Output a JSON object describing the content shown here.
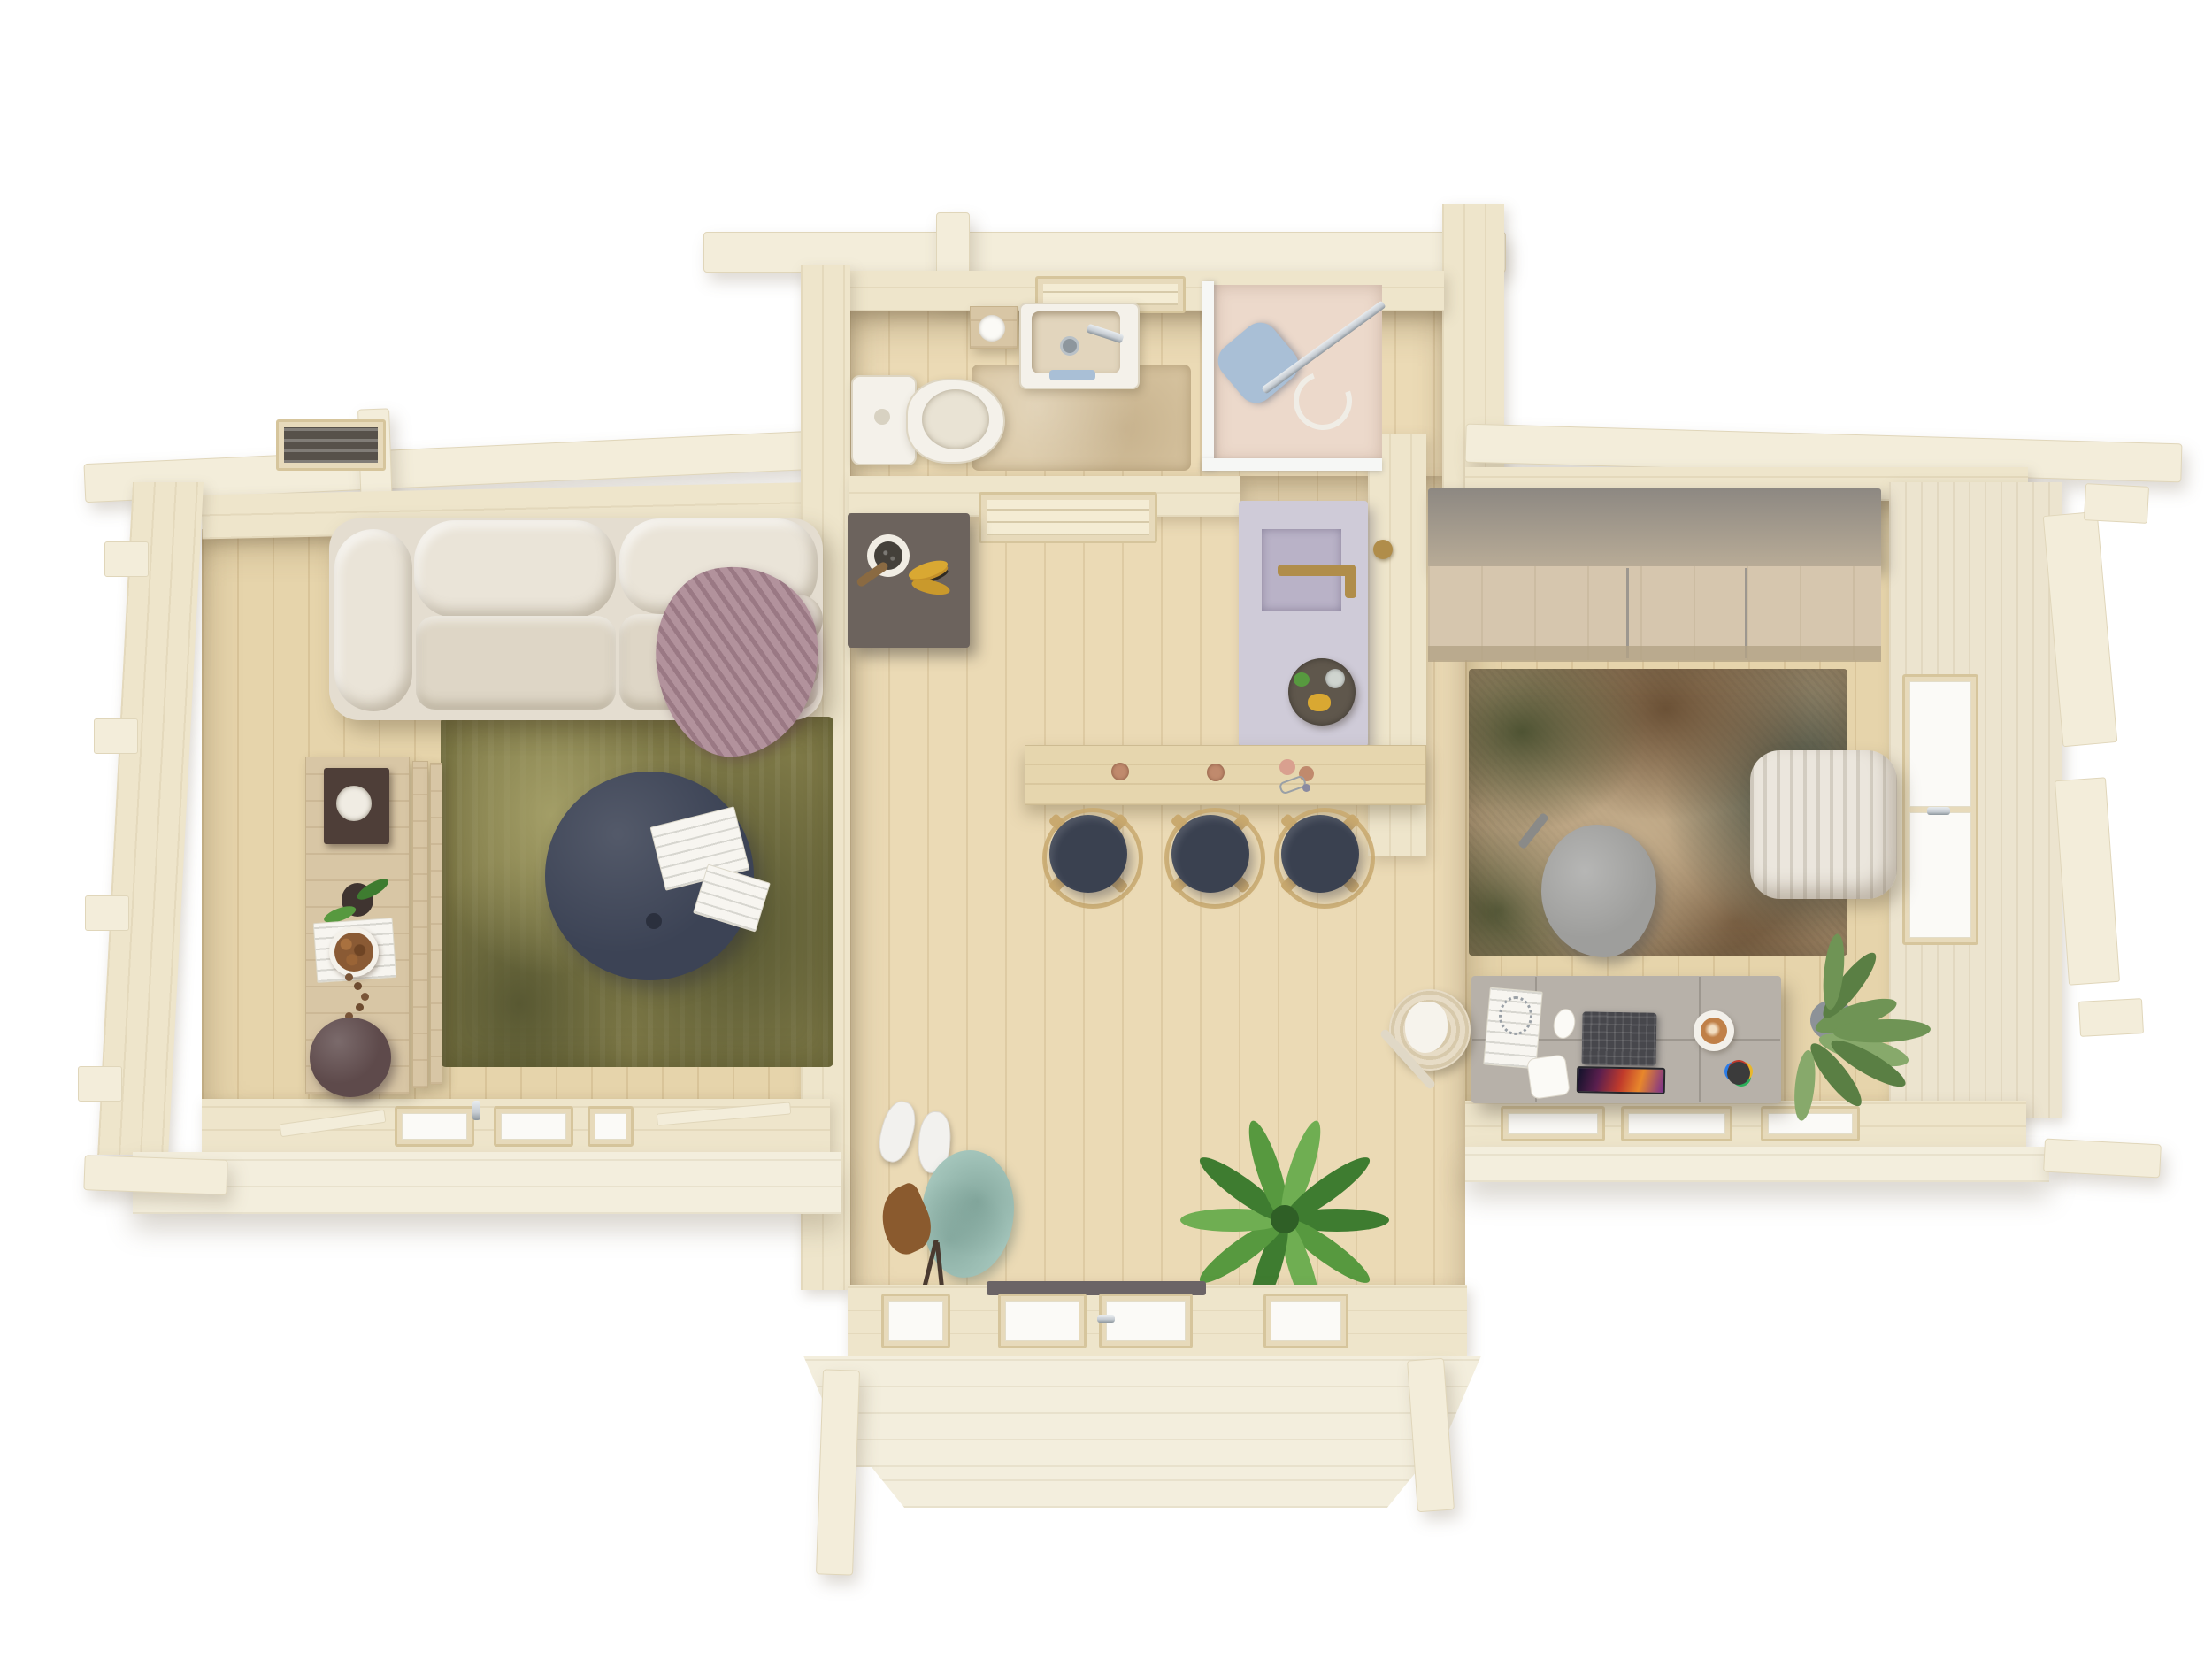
{
  "scene": {
    "title": "log-cabin-floor-plan-top-view",
    "style": "photorealistic 3D top-down architectural render, no visible text",
    "background": "#ffffff"
  },
  "palette": {
    "bg": "#ffffff",
    "beam": "#f3edda",
    "beam_bd": "#e0d6ba",
    "wall": "#eee5cb",
    "outerface": "#ece4cf",
    "floor": "#ebdab5",
    "floor_room": "#e6d4ab",
    "glass": "#fbfaf7",
    "frame": "#e7dabb",
    "frame_bd": "#d6c59c",
    "skydark": "#57514a",
    "threshold": "#6b6466",
    "porch": "#f3eedd",
    "sofa": "#e4ddd0",
    "sofa_hi": "#eae4d8",
    "sofa_seat": "#ded6c6",
    "blanket": "#b2929c",
    "rug1": "#7e7947",
    "rug1_dk": "#585832",
    "rug1_lt": "#a39e67",
    "navy": "#3c4355",
    "paper": "#f7f5f0",
    "bench": "#d8c6a5",
    "book": "#4e3e38",
    "nuts": "#8a5a34",
    "plum": "#5e4a4b",
    "white_fix": "#f4f1ea",
    "basin": "#e2d5bd",
    "bathrug": "#d9c6a2",
    "showerfl": "#ecd9cb",
    "pad": "#a9bfd6",
    "chrome": "#c6ccd2",
    "darkcab": "#6c635d",
    "banana": "#d9a832",
    "plate": "#f0ece3",
    "door": "#cfcbd8",
    "doorglass": "#b9b2c7",
    "gold": "#b08d4a",
    "tray": "#5f574c",
    "counter": "#e6d6ae",
    "stool": "#3a4150",
    "stoolwood": "#c9a96f",
    "copper": "#c08a6d",
    "rose": "#d9a08f",
    "sneaker": "#f2f1ee",
    "jacket": "#a7c8be",
    "dryleaf": "#8a5a2e",
    "branch": "#4a3a30",
    "plantd": "#3e7c30",
    "plantm": "#57993f",
    "plantl": "#6fae52",
    "wrfront": "#d6c6ae",
    "wrtop": "#8d8882",
    "rug2": "#b29a79",
    "rug2_dk": "#4e5333",
    "rug2_br": "#6b5136",
    "rug2_gr": "#3f4a3e",
    "rug2_lt": "#c3ac8a",
    "poufw": "#ebe6dd",
    "chairg": "#9e9e9c",
    "desk": "#b7b1a9",
    "deskseam": "#9d978f",
    "laptop": "#47474c",
    "latte": "#c08048",
    "saucer": "#f3f0ea",
    "oplantd": "#5a7f44",
    "oplantm": "#6f9455",
    "oplantl": "#87a96b",
    "basket": "#e7dcc6",
    "basketrg": "#d7c9ab"
  },
  "rooms": {
    "living_room": {
      "name": "living room",
      "furniture": [
        "corner sofa",
        "mauve throw blanket",
        "two round cushions",
        "olive green rug",
        "navy round coffee table",
        "magazines on table",
        "wall bench",
        "coffee-table book",
        "plant pot",
        "bowl of nuts",
        "bead garland",
        "plum floor pouf"
      ],
      "window_count": 3
    },
    "bathroom": {
      "name": "bathroom",
      "fixtures": [
        "toilet",
        "washbasin cabinet",
        "toilet paper holder",
        "bath mat",
        "shower cabin with glass wall",
        "open door with glass pane and brass handle"
      ]
    },
    "hall": {
      "name": "hall with bar",
      "items": [
        "dark sideboard",
        "decor plate",
        "bananas",
        "skylight window",
        "bar counter",
        "copper cups",
        "bar stools"
      ],
      "stool_count": 3
    },
    "entry": {
      "name": "entry",
      "items": [
        "white sneakers",
        "sage hanging jacket",
        "dried leaf and branches",
        "potted palm",
        "glazed front door",
        "wooden porch with posts"
      ]
    },
    "office": {
      "name": "office lounge",
      "items": [
        "wardrobe with grey top",
        "abstract green-brown rug",
        "grey lounge chair",
        "white ribbed pouf",
        "grey desk",
        "open laptop",
        "cappuccino cup",
        "notebook",
        "computer mouse",
        "pen cup",
        "large green plant",
        "wicker basket"
      ],
      "window_count": 3
    }
  }
}
